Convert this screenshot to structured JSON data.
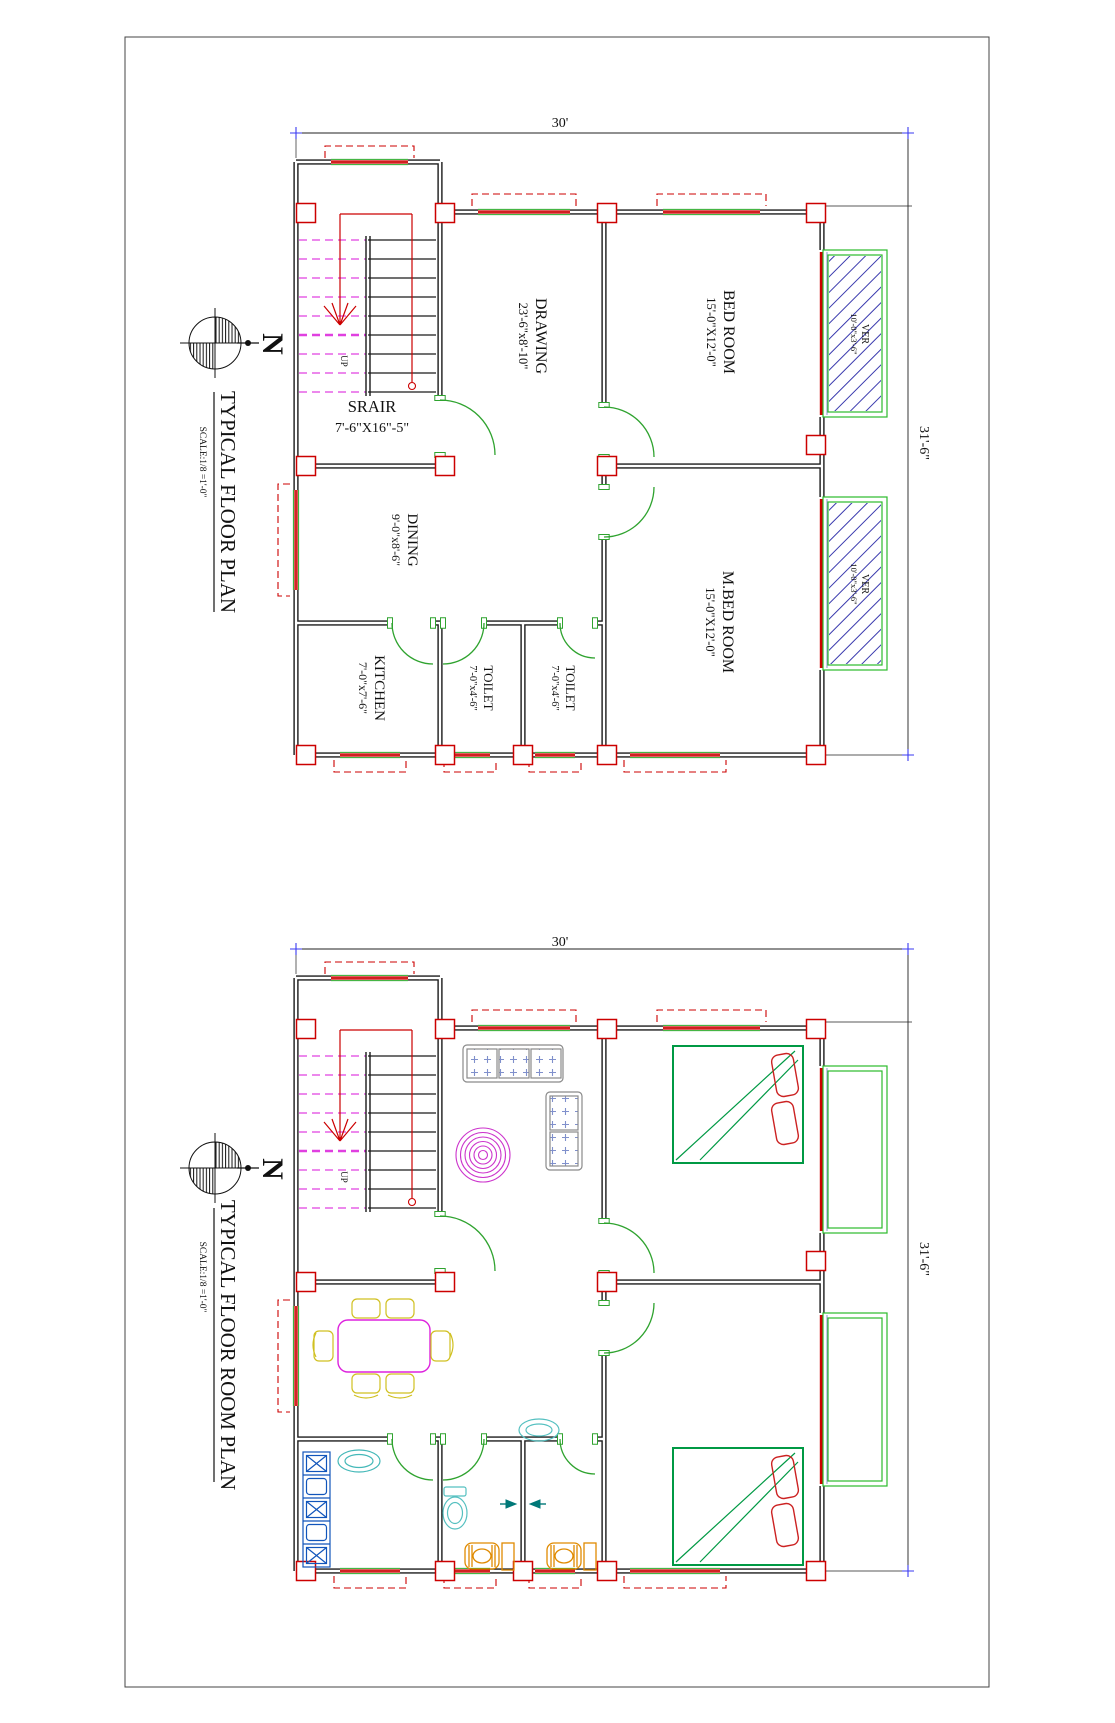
{
  "colors": {
    "wall": "#1a1a1a",
    "structure_red": "#cc0000",
    "door_window_green": "#2fa32f",
    "veranda_green": "#2bbb2b",
    "stair_magenta": "#e040e0",
    "hatch_blue": "#3a3aae",
    "dim_cross_blue": "#3a3af0",
    "sofa_gray": "#8a8a8a",
    "cushion_blue": "#8090cc",
    "rug_magenta": "#cc33cc",
    "bed_green": "#009944",
    "pillow_red": "#cc2222",
    "table_magenta": "#dd22dd",
    "chair_yellow": "#d0c020",
    "kitchen_blue": "#1155bb",
    "fixture_cyan": "#55c0c0",
    "pan_orange": "#e08a00",
    "shower_teal": "#007878"
  },
  "shared": {
    "north_label": "N",
    "up_label": "UP",
    "width_dim": "30'",
    "height_dim": "31'-6\""
  },
  "plan_top": {
    "title": "TYPICAL FLOOR PLAN",
    "scale": "SCALE:1/8 =1'-0\"",
    "rooms": [
      {
        "name": "SRAIR",
        "dims": "7'-6\"X16\"-5\""
      },
      {
        "name": "DRAWING",
        "dims": "23'-6\"x8'-10\""
      },
      {
        "name": "BED ROOM",
        "dims": "15'-0\"X12'-0\""
      },
      {
        "name": "M.BED ROOM",
        "dims": "15'-0\"X12'-0\""
      },
      {
        "name": "DINING",
        "dims": "9'-0\"x8'-6\""
      },
      {
        "name": "KITCHEN",
        "dims": "7'-0\"x7'-6\""
      },
      {
        "name": "TOILET",
        "dims": "7'-0\"x4'-6\""
      },
      {
        "name": "TOILET",
        "dims": "7'-0\"x4'-6\""
      },
      {
        "name": "VER",
        "dims": "10'-0\"x3'-6\""
      },
      {
        "name": "VER",
        "dims": "10'-0\"x3'-6\""
      }
    ]
  },
  "plan_bottom": {
    "title": "TYPICAL FLOOR ROOM PLAN",
    "scale": "SCALE:1/8 =1'-0\""
  }
}
